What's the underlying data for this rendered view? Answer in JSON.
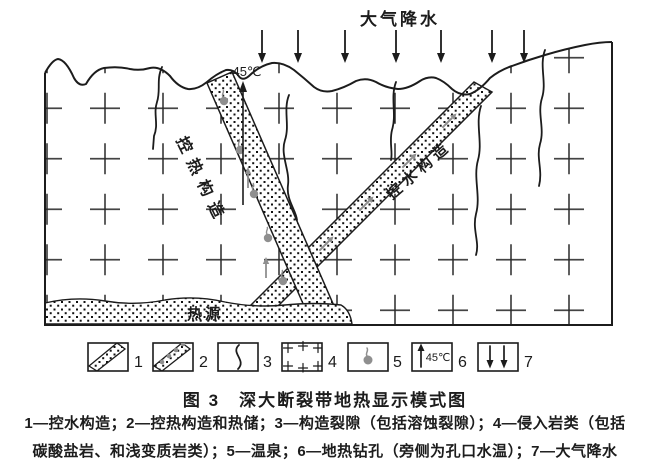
{
  "figure": {
    "precipitation_label": "大气降水",
    "borehole_temp": "45℃",
    "heat_band_label": "控热构造",
    "water_band_label": "控水构造",
    "heat_source_label": "热源"
  },
  "legend": {
    "numbers": [
      "1",
      "2",
      "3",
      "4",
      "5",
      "6",
      "7"
    ],
    "borehole_temp": "45℃"
  },
  "caption": "图 3　深大断裂带地热显示模式图",
  "description": {
    "line1": "1—控水构造；2—控热构造和热储；3—构造裂隙（包括溶蚀裂隙）；4—侵入岩类（包括",
    "line2": "碳酸盐岩、和浅变质岩类）；5—温泉；6—地热钻孔（旁侧为孔口水温）；7—大气降水"
  },
  "colors": {
    "ink": "#1c1c1c",
    "gray_symbol": "#8f8f8f",
    "background": "#ffffff"
  }
}
